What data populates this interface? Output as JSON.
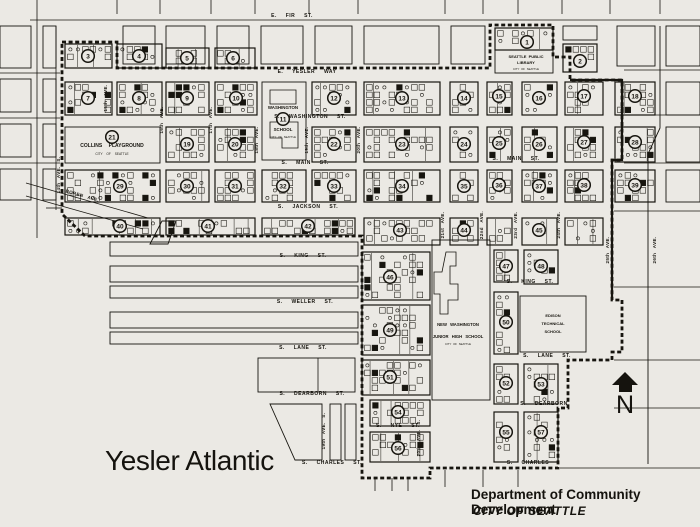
{
  "title": "Yesler Atlantic",
  "attribution": {
    "department": "Department of Community Development",
    "city": "CITY OF SEATTLE"
  },
  "compass": {
    "label": "N"
  },
  "colors": {
    "paper": "#ebe9e4",
    "ink": "#17150f"
  },
  "street_labels": [
    {
      "text": "E. FIR ST.",
      "x": 292,
      "y": 17
    },
    {
      "text": "E. YESLER WAY",
      "x": 307,
      "y": 73
    },
    {
      "text": "S. WASHINGTON ST.",
      "x": 310,
      "y": 118
    },
    {
      "text": "S. MAIN ST.",
      "x": 305,
      "y": 164
    },
    {
      "text": "S. MAIN ST.",
      "x": 516,
      "y": 160
    },
    {
      "text": "S. JACKSON ST.",
      "x": 308,
      "y": 208
    },
    {
      "text": "S. KING ST.",
      "x": 303,
      "y": 257
    },
    {
      "text": "S. KING ST.",
      "x": 530,
      "y": 283
    },
    {
      "text": "S. WELLER ST.",
      "x": 305,
      "y": 303
    },
    {
      "text": "S. LANE ST.",
      "x": 303,
      "y": 349
    },
    {
      "text": "S. LANE ST.",
      "x": 547,
      "y": 357
    },
    {
      "text": "S. DEARBORN ST.",
      "x": 312,
      "y": 395
    },
    {
      "text": "S. DEARBORN",
      "x": 544,
      "y": 405
    },
    {
      "text": "S. NYE ST.",
      "x": 398,
      "y": 427
    },
    {
      "text": "S. CHARLES ST.",
      "x": 332,
      "y": 464
    },
    {
      "text": "S. CHARLES",
      "x": 528,
      "y": 464
    }
  ],
  "avenue_labels": [
    {
      "text": "BOREN AVE.",
      "x": 82,
      "y": 197,
      "rot": 16
    },
    {
      "text": "14th AVE. S.",
      "x": 60,
      "y": 175,
      "rot": -90
    },
    {
      "text": "15th AVE.",
      "x": 107,
      "y": 98,
      "rot": -90
    },
    {
      "text": "16th AVE.",
      "x": 163,
      "y": 120,
      "rot": -90
    },
    {
      "text": "17th AVE.",
      "x": 212,
      "y": 120,
      "rot": -90
    },
    {
      "text": "18th AVE.",
      "x": 258,
      "y": 140,
      "rot": -90
    },
    {
      "text": "19th AVE.",
      "x": 308,
      "y": 140,
      "rot": -90
    },
    {
      "text": "20th AVE.",
      "x": 360,
      "y": 140,
      "rot": -90
    },
    {
      "text": "21st AVE.",
      "x": 444,
      "y": 225,
      "rot": -90
    },
    {
      "text": "22nd AVE.",
      "x": 483,
      "y": 225,
      "rot": -90
    },
    {
      "text": "23rd AVE.",
      "x": 517,
      "y": 225,
      "rot": -90
    },
    {
      "text": "24th AVE.",
      "x": 560,
      "y": 225,
      "rot": -90
    },
    {
      "text": "25th AVE.",
      "x": 609,
      "y": 250,
      "rot": -90
    },
    {
      "text": "26th AVE.",
      "x": 656,
      "y": 250,
      "rot": -90
    },
    {
      "text": "19th AVE. S.",
      "x": 325,
      "y": 431,
      "rot": -90
    },
    {
      "text": "20th AVE. S.",
      "x": 420,
      "y": 438,
      "rot": -90
    }
  ],
  "landmark_labels": [
    {
      "text": "COLLINS PLAYGROUND",
      "x": 112,
      "y": 147,
      "size": 5,
      "bold": true,
      "ws": 5
    },
    {
      "text": "CITY OF SEATTLE",
      "x": 112,
      "y": 155,
      "size": 3.2,
      "bold": false,
      "ws": 3
    },
    {
      "text": "WASHINGTON",
      "x": 283,
      "y": 109,
      "size": 4.4,
      "bold": true,
      "ws": 1
    },
    {
      "text": "SCHOOL",
      "x": 283,
      "y": 131,
      "size": 4.4,
      "bold": true,
      "ws": 1
    },
    {
      "text": "CITY OF SEATTLE",
      "x": 283,
      "y": 138,
      "size": 2.8,
      "bold": false,
      "ws": 1
    },
    {
      "text": "SEATTLE PUBLIC",
      "x": 526,
      "y": 58,
      "size": 4,
      "bold": true,
      "ws": 1
    },
    {
      "text": "LIBRARY",
      "x": 526,
      "y": 64,
      "size": 4,
      "bold": true,
      "ws": 1
    },
    {
      "text": "CITY OF SEATTLE",
      "x": 526,
      "y": 70,
      "size": 2.8,
      "bold": false,
      "ws": 1
    },
    {
      "text": "NEW WASHINGTON",
      "x": 458,
      "y": 326,
      "size": 4.2,
      "bold": true,
      "ws": 2
    },
    {
      "text": "JUNIOR HIGH SCHOOL",
      "x": 458,
      "y": 338,
      "size": 4.2,
      "bold": true,
      "ws": 2
    },
    {
      "text": "CITY OF SEATTLE",
      "x": 458,
      "y": 345,
      "size": 2.8,
      "bold": false,
      "ws": 1
    },
    {
      "text": "EDISON",
      "x": 553,
      "y": 317,
      "size": 4,
      "bold": true,
      "ws": 1
    },
    {
      "text": "TECHNICAL",
      "x": 553,
      "y": 325,
      "size": 4,
      "bold": true,
      "ws": 1
    },
    {
      "text": "SCHOOL",
      "x": 553,
      "y": 333,
      "size": 4,
      "bold": true,
      "ws": 1
    }
  ],
  "blocks": [
    {
      "x": 65,
      "y": 44,
      "w": 47,
      "h": 24,
      "t": "tex"
    },
    {
      "x": 117,
      "y": 44,
      "w": 45,
      "h": 24,
      "t": "tex"
    },
    {
      "x": 166,
      "y": 48,
      "w": 43,
      "h": 20,
      "t": "tex"
    },
    {
      "x": 215,
      "y": 48,
      "w": 40,
      "h": 20,
      "t": "tex"
    },
    {
      "x": 563,
      "y": 44,
      "w": 34,
      "h": 28,
      "t": "tex"
    },
    {
      "x": 495,
      "y": 28,
      "w": 58,
      "h": 22,
      "t": "tex"
    },
    {
      "x": 495,
      "y": 50,
      "w": 58,
      "h": 23,
      "t": "open"
    },
    {
      "x": 65,
      "y": 82,
      "w": 47,
      "h": 33,
      "t": "tex"
    },
    {
      "x": 117,
      "y": 82,
      "w": 45,
      "h": 33,
      "t": "tex"
    },
    {
      "x": 166,
      "y": 82,
      "w": 43,
      "h": 33,
      "t": "tex"
    },
    {
      "x": 215,
      "y": 82,
      "w": 42,
      "h": 33,
      "t": "tex"
    },
    {
      "x": 262,
      "y": 82,
      "w": 44,
      "h": 78,
      "t": "open"
    },
    {
      "x": 312,
      "y": 82,
      "w": 44,
      "h": 33,
      "t": "tex"
    },
    {
      "x": 364,
      "y": 82,
      "w": 76,
      "h": 33,
      "t": "tex"
    },
    {
      "x": 450,
      "y": 82,
      "w": 28,
      "h": 33,
      "t": "tex"
    },
    {
      "x": 487,
      "y": 82,
      "w": 25,
      "h": 33,
      "t": "tex"
    },
    {
      "x": 522,
      "y": 82,
      "w": 35,
      "h": 33,
      "t": "tex"
    },
    {
      "x": 565,
      "y": 82,
      "w": 38,
      "h": 33,
      "t": "tex"
    },
    {
      "x": 615,
      "y": 82,
      "w": 40,
      "h": 33,
      "t": "tex"
    },
    {
      "x": 65,
      "y": 127,
      "w": 95,
      "h": 36,
      "t": "open"
    },
    {
      "x": 166,
      "y": 127,
      "w": 43,
      "h": 35,
      "t": "tex"
    },
    {
      "x": 215,
      "y": 127,
      "w": 40,
      "h": 35,
      "t": "tex"
    },
    {
      "x": 312,
      "y": 127,
      "w": 44,
      "h": 35,
      "t": "tex"
    },
    {
      "x": 364,
      "y": 127,
      "w": 76,
      "h": 35,
      "t": "tex"
    },
    {
      "x": 450,
      "y": 127,
      "w": 28,
      "h": 35,
      "t": "tex"
    },
    {
      "x": 487,
      "y": 127,
      "w": 25,
      "h": 35,
      "t": "tex"
    },
    {
      "x": 522,
      "y": 127,
      "w": 35,
      "h": 35,
      "t": "tex"
    },
    {
      "x": 565,
      "y": 127,
      "w": 38,
      "h": 35,
      "t": "tex"
    },
    {
      "x": 615,
      "y": 127,
      "w": 40,
      "h": 35,
      "t": "tex"
    },
    {
      "x": 65,
      "y": 170,
      "w": 95,
      "h": 32,
      "t": "tex"
    },
    {
      "x": 166,
      "y": 170,
      "w": 43,
      "h": 32,
      "t": "tex"
    },
    {
      "x": 215,
      "y": 170,
      "w": 40,
      "h": 32,
      "t": "tex"
    },
    {
      "x": 262,
      "y": 170,
      "w": 44,
      "h": 32,
      "t": "tex"
    },
    {
      "x": 312,
      "y": 170,
      "w": 44,
      "h": 32,
      "t": "tex"
    },
    {
      "x": 364,
      "y": 170,
      "w": 76,
      "h": 32,
      "t": "tex"
    },
    {
      "x": 450,
      "y": 170,
      "w": 28,
      "h": 32,
      "t": "tex"
    },
    {
      "x": 487,
      "y": 170,
      "w": 25,
      "h": 32,
      "t": "tex"
    },
    {
      "x": 522,
      "y": 170,
      "w": 35,
      "h": 32,
      "t": "tex"
    },
    {
      "x": 565,
      "y": 170,
      "w": 38,
      "h": 32,
      "t": "tex"
    },
    {
      "x": 615,
      "y": 170,
      "w": 40,
      "h": 32,
      "t": "tex"
    },
    {
      "x": 65,
      "y": 218,
      "w": 95,
      "h": 17,
      "t": "tex"
    },
    {
      "x": 166,
      "y": 218,
      "w": 89,
      "h": 17,
      "t": "tex"
    },
    {
      "x": 262,
      "y": 218,
      "w": 93,
      "h": 17,
      "t": "tex"
    },
    {
      "x": 364,
      "y": 218,
      "w": 76,
      "h": 27,
      "t": "tex"
    },
    {
      "x": 450,
      "y": 218,
      "w": 28,
      "h": 27,
      "t": "tex"
    },
    {
      "x": 487,
      "y": 218,
      "w": 25,
      "h": 27,
      "t": "tex"
    },
    {
      "x": 522,
      "y": 218,
      "w": 35,
      "h": 27,
      "t": "tex"
    },
    {
      "x": 565,
      "y": 218,
      "w": 38,
      "h": 27,
      "t": "tex"
    },
    {
      "x": 362,
      "y": 252,
      "w": 68,
      "h": 48,
      "t": "tex"
    },
    {
      "x": 362,
      "y": 305,
      "w": 68,
      "h": 50,
      "t": "tex"
    },
    {
      "x": 362,
      "y": 360,
      "w": 68,
      "h": 35,
      "t": "tex"
    },
    {
      "x": 370,
      "y": 400,
      "w": 60,
      "h": 26,
      "t": "tex"
    },
    {
      "x": 370,
      "y": 432,
      "w": 60,
      "h": 30,
      "t": "tex"
    },
    {
      "x": 432,
      "y": 240,
      "w": 58,
      "h": 160,
      "t": "open"
    },
    {
      "x": 494,
      "y": 250,
      "w": 24,
      "h": 32,
      "t": "tex"
    },
    {
      "x": 494,
      "y": 292,
      "w": 24,
      "h": 62,
      "t": "tex"
    },
    {
      "x": 494,
      "y": 364,
      "w": 24,
      "h": 40,
      "t": "tex"
    },
    {
      "x": 494,
      "y": 412,
      "w": 24,
      "h": 50,
      "t": "tex"
    },
    {
      "x": 524,
      "y": 250,
      "w": 34,
      "h": 34,
      "t": "tex"
    },
    {
      "x": 520,
      "y": 296,
      "w": 66,
      "h": 56,
      "t": "open"
    },
    {
      "x": 524,
      "y": 364,
      "w": 34,
      "h": 40,
      "t": "tex"
    },
    {
      "x": 524,
      "y": 412,
      "w": 34,
      "h": 50,
      "t": "tex"
    },
    {
      "x": 123,
      "y": 26,
      "w": 32,
      "h": 38,
      "t": "open"
    },
    {
      "x": 166,
      "y": 26,
      "w": 39,
      "h": 38,
      "t": "open"
    },
    {
      "x": 217,
      "y": 26,
      "w": 32,
      "h": 38,
      "t": "open"
    },
    {
      "x": 261,
      "y": 26,
      "w": 42,
      "h": 38,
      "t": "open"
    },
    {
      "x": 315,
      "y": 26,
      "w": 37,
      "h": 38,
      "t": "open"
    },
    {
      "x": 364,
      "y": 26,
      "w": 75,
      "h": 38,
      "t": "open"
    },
    {
      "x": 451,
      "y": 26,
      "w": 34,
      "h": 38,
      "t": "open"
    },
    {
      "x": 563,
      "y": 26,
      "w": 34,
      "h": 14,
      "t": "open"
    },
    {
      "x": 617,
      "y": 26,
      "w": 38,
      "h": 40,
      "t": "open"
    },
    {
      "x": 666,
      "y": 26,
      "w": 34,
      "h": 40,
      "t": "open"
    },
    {
      "x": 666,
      "y": 82,
      "w": 34,
      "h": 33,
      "t": "open"
    },
    {
      "x": 666,
      "y": 127,
      "w": 34,
      "h": 35,
      "t": "open"
    },
    {
      "x": 666,
      "y": 170,
      "w": 34,
      "h": 32,
      "t": "open"
    },
    {
      "x": 0,
      "y": 26,
      "w": 31,
      "h": 42,
      "t": "open"
    },
    {
      "x": 0,
      "y": 79,
      "w": 31,
      "h": 33,
      "t": "open"
    },
    {
      "x": 0,
      "y": 124,
      "w": 31,
      "h": 33,
      "t": "open"
    },
    {
      "x": 0,
      "y": 169,
      "w": 31,
      "h": 31,
      "t": "open"
    },
    {
      "x": 43,
      "y": 26,
      "w": 13,
      "h": 42,
      "t": "open"
    },
    {
      "x": 43,
      "y": 79,
      "w": 13,
      "h": 33,
      "t": "open"
    },
    {
      "x": 43,
      "y": 124,
      "w": 13,
      "h": 33,
      "t": "open"
    },
    {
      "x": 43,
      "y": 169,
      "w": 13,
      "h": 31,
      "t": "open"
    },
    {
      "x": 110,
      "y": 242,
      "w": 248,
      "h": 14,
      "t": "open"
    },
    {
      "x": 110,
      "y": 266,
      "w": 248,
      "h": 16,
      "t": "open"
    },
    {
      "x": 110,
      "y": 286,
      "w": 248,
      "h": 12,
      "t": "open"
    },
    {
      "x": 110,
      "y": 312,
      "w": 248,
      "h": 16,
      "t": "open"
    },
    {
      "x": 110,
      "y": 332,
      "w": 248,
      "h": 12,
      "t": "open"
    },
    {
      "x": 258,
      "y": 358,
      "w": 97,
      "h": 34,
      "t": "open"
    },
    {
      "x": 330,
      "y": 404,
      "w": 11,
      "h": 56,
      "t": "open"
    },
    {
      "x": 345,
      "y": 404,
      "w": 11,
      "h": 56,
      "t": "open"
    }
  ],
  "block_numbers": [
    {
      "n": "1",
      "x": 527,
      "y": 42
    },
    {
      "n": "2",
      "x": 580,
      "y": 61
    },
    {
      "n": "3",
      "x": 88,
      "y": 56
    },
    {
      "n": "4",
      "x": 139,
      "y": 56
    },
    {
      "n": "5",
      "x": 187,
      "y": 58
    },
    {
      "n": "6",
      "x": 233,
      "y": 58
    },
    {
      "n": "7",
      "x": 88,
      "y": 98
    },
    {
      "n": "8",
      "x": 139,
      "y": 98
    },
    {
      "n": "9",
      "x": 187,
      "y": 98
    },
    {
      "n": "10",
      "x": 236,
      "y": 98
    },
    {
      "n": "11",
      "x": 283,
      "y": 119
    },
    {
      "n": "12",
      "x": 334,
      "y": 98
    },
    {
      "n": "13",
      "x": 402,
      "y": 98
    },
    {
      "n": "14",
      "x": 464,
      "y": 98
    },
    {
      "n": "15",
      "x": 499,
      "y": 96
    },
    {
      "n": "16",
      "x": 539,
      "y": 98
    },
    {
      "n": "17",
      "x": 584,
      "y": 96
    },
    {
      "n": "18",
      "x": 635,
      "y": 96
    },
    {
      "n": "19",
      "x": 187,
      "y": 144
    },
    {
      "n": "20",
      "x": 235,
      "y": 144
    },
    {
      "n": "21",
      "x": 112,
      "y": 137
    },
    {
      "n": "22",
      "x": 334,
      "y": 144
    },
    {
      "n": "23",
      "x": 402,
      "y": 144
    },
    {
      "n": "24",
      "x": 464,
      "y": 144
    },
    {
      "n": "25",
      "x": 499,
      "y": 143
    },
    {
      "n": "26",
      "x": 539,
      "y": 144
    },
    {
      "n": "27",
      "x": 584,
      "y": 142
    },
    {
      "n": "28",
      "x": 635,
      "y": 142
    },
    {
      "n": "29",
      "x": 120,
      "y": 186
    },
    {
      "n": "30",
      "x": 187,
      "y": 186
    },
    {
      "n": "31",
      "x": 235,
      "y": 186
    },
    {
      "n": "32",
      "x": 283,
      "y": 186
    },
    {
      "n": "33",
      "x": 334,
      "y": 186
    },
    {
      "n": "34",
      "x": 402,
      "y": 186
    },
    {
      "n": "35",
      "x": 464,
      "y": 186
    },
    {
      "n": "36",
      "x": 499,
      "y": 185
    },
    {
      "n": "37",
      "x": 539,
      "y": 186
    },
    {
      "n": "38",
      "x": 584,
      "y": 185
    },
    {
      "n": "39",
      "x": 635,
      "y": 185
    },
    {
      "n": "40",
      "x": 120,
      "y": 226
    },
    {
      "n": "41",
      "x": 208,
      "y": 226
    },
    {
      "n": "42",
      "x": 308,
      "y": 226
    },
    {
      "n": "43",
      "x": 400,
      "y": 230
    },
    {
      "n": "44",
      "x": 464,
      "y": 230
    },
    {
      "n": "45",
      "x": 539,
      "y": 230
    },
    {
      "n": "46",
      "x": 390,
      "y": 277
    },
    {
      "n": "47",
      "x": 506,
      "y": 266
    },
    {
      "n": "48",
      "x": 541,
      "y": 266
    },
    {
      "n": "49",
      "x": 390,
      "y": 330
    },
    {
      "n": "50",
      "x": 506,
      "y": 322
    },
    {
      "n": "51",
      "x": 390,
      "y": 377
    },
    {
      "n": "52",
      "x": 506,
      "y": 383
    },
    {
      "n": "53",
      "x": 541,
      "y": 384
    },
    {
      "n": "54",
      "x": 398,
      "y": 412
    },
    {
      "n": "55",
      "x": 506,
      "y": 432
    },
    {
      "n": "56",
      "x": 398,
      "y": 448
    },
    {
      "n": "57",
      "x": 541,
      "y": 432
    }
  ],
  "grid_lines": [
    [
      30,
      20,
      700,
      20
    ],
    [
      0,
      73,
      60,
      73
    ],
    [
      0,
      118,
      60,
      118
    ],
    [
      0,
      163,
      60,
      163
    ],
    [
      46,
      208,
      62,
      208
    ],
    [
      37,
      0,
      37,
      238
    ],
    [
      56,
      26,
      56,
      210
    ],
    [
      117,
      0,
      117,
      14
    ],
    [
      160,
      0,
      160,
      14
    ],
    [
      211,
      0,
      211,
      14
    ],
    [
      255,
      0,
      255,
      14
    ],
    [
      309,
      0,
      309,
      14
    ],
    [
      358,
      0,
      358,
      14
    ],
    [
      445,
      0,
      445,
      14
    ],
    [
      483,
      0,
      483,
      14
    ],
    [
      518,
      0,
      518,
      14
    ],
    [
      562,
      0,
      562,
      14
    ],
    [
      610,
      0,
      610,
      14
    ],
    [
      660,
      0,
      660,
      14
    ],
    [
      624,
      70,
      700,
      70
    ],
    [
      624,
      115,
      700,
      115
    ],
    [
      624,
      163,
      700,
      163
    ],
    [
      614,
      211,
      700,
      211
    ],
    [
      614,
      287,
      700,
      287
    ],
    [
      614,
      360,
      700,
      360
    ],
    [
      614,
      408,
      700,
      408
    ],
    [
      560,
      468,
      700,
      468
    ],
    [
      375,
      478,
      375,
      491
    ],
    [
      392,
      478,
      392,
      491
    ],
    [
      408,
      478,
      408,
      491
    ],
    [
      445,
      470,
      445,
      487
    ],
    [
      483,
      470,
      483,
      487
    ],
    [
      518,
      470,
      518,
      487
    ],
    [
      26,
      183,
      148,
      218
    ],
    [
      26,
      196,
      143,
      229
    ],
    [
      318,
      358,
      318,
      392
    ]
  ],
  "polylines": [
    {
      "pts": "660,26 660,128 648,154 648,464",
      "closed": false
    },
    {
      "pts": "150,244 162,221 176,221 168,244",
      "closed": true
    },
    {
      "pts": "270,404 322,404 322,460 295,460",
      "closed": true
    }
  ],
  "boundary": {
    "dashed": "M62,42 H117 V68 H490 V25 H553 V57 H570 V80 H622 V160 H612 V300 H622 V352 H612 V360 H568 V408 H558 V468 H430 V478 H362 V236 H85 L62,214 Z",
    "solid": "M570,80 H622 V160 H612 V300"
  },
  "footprints": [
    "M446,252 h10 v14 h-6 v18 h8 v16 h-10 v14 h-8 v-20 h-6 v-22 h8 z",
    "M270,90 h26 v14 h-26 z",
    "M270,122 h28 v26 h-16 v-10 h-12 z"
  ]
}
